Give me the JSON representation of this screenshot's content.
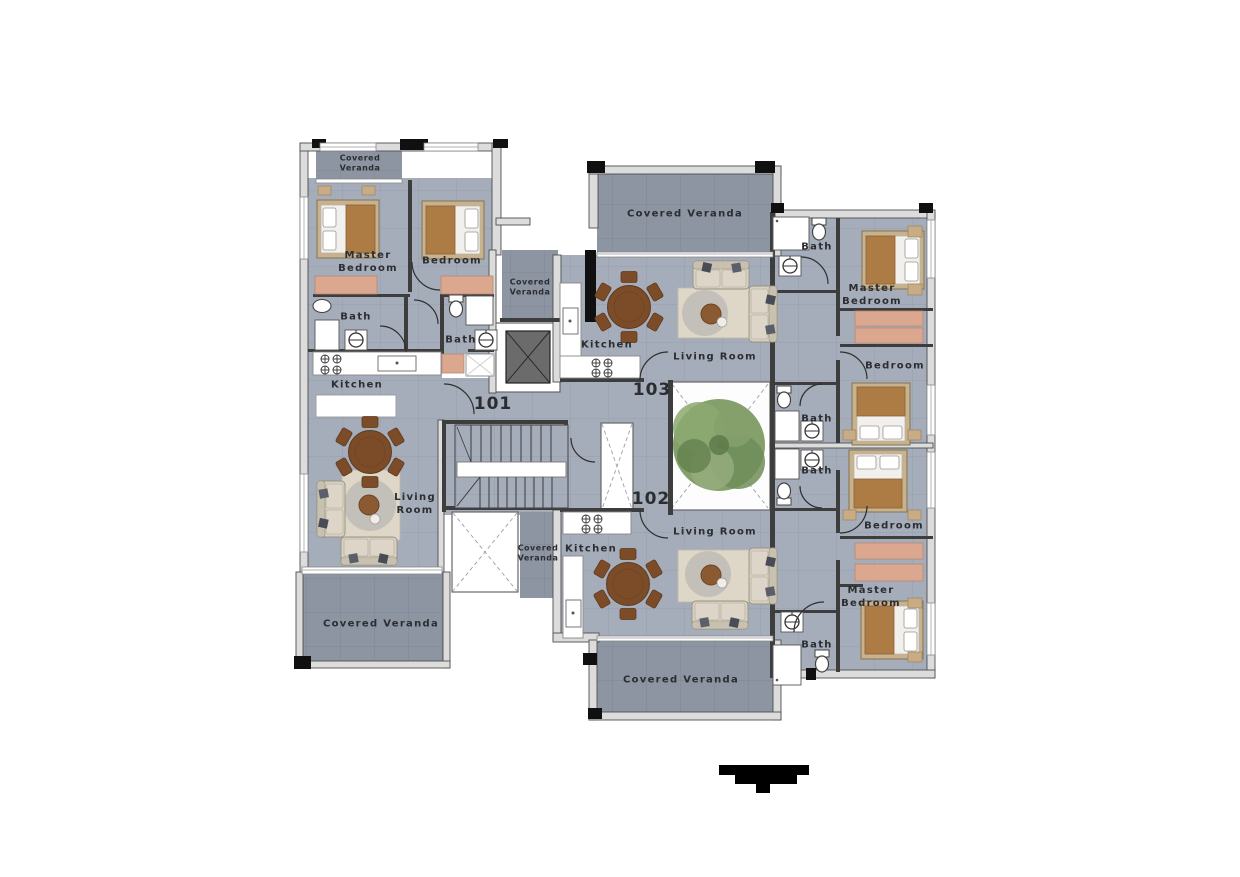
{
  "plan": {
    "units": {
      "u101": "101",
      "u102": "102",
      "u103": "103"
    },
    "labels": {
      "a101_veranda_top": "Covered\nVeranda",
      "a101_master": "Master\nBedroom",
      "a101_bedroom": "Bedroom",
      "a101_bath1": "Bath",
      "a101_bath2": "Bath",
      "a101_kitchen": "Kitchen",
      "core_veranda_upper": "Covered\nVeranda",
      "a101_living": "Living\nRoom",
      "a101_veranda_bottom": "Covered Veranda",
      "a103_veranda": "Covered Veranda",
      "a103_kitchen": "Kitchen",
      "a103_living": "Living Room",
      "a103_bath_top": "Bath",
      "a103_master": "Master\nBedroom",
      "a103_bedroom": "Bedroom",
      "a103_bath_mid": "Bath",
      "a102_bath_mid": "Bath",
      "a102_living": "Living Room",
      "a102_kitchen": "Kitchen",
      "core_veranda_lower": "Covered\nVeranda",
      "a102_bedroom": "Bedroom",
      "a102_master": "Master\nBedroom",
      "a102_bath_bottom": "Bath",
      "a102_veranda": "Covered Veranda"
    },
    "colors": {
      "floor": "#a6adba",
      "veranda_floor": "#8d95a2",
      "wall_light": "#dcdcdc",
      "wall_dark": "#3d3d3d",
      "fixture_white": "#ffffff",
      "wood_table": "#7c4c28",
      "bed_blanket": "#ad7c45",
      "wardrobe": "#dba88f",
      "sofa": "#d8d1c3",
      "rug": "#ded7c8",
      "tree_green": "#7d9b63",
      "elevator_cab": "#6b6b6b",
      "text": "#2b2d31"
    }
  }
}
